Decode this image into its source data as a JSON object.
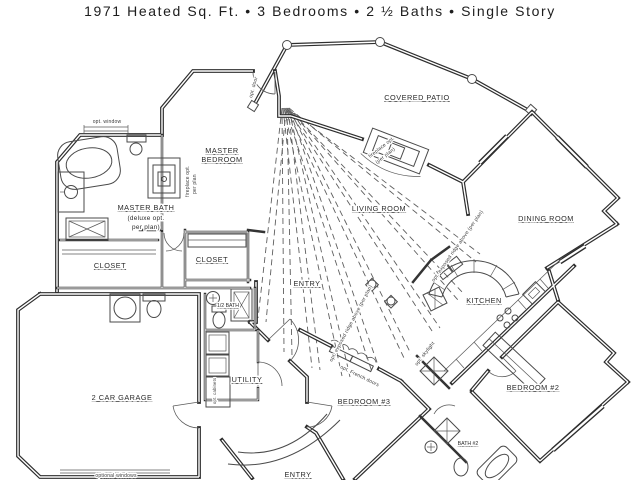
{
  "title": "1971 Heated Sq. Ft. • 3 Bedrooms • 2 ½ Baths • Single Story",
  "rooms": {
    "covered_patio": "COVERED PATIO",
    "master_line1": "MASTER",
    "master_line2": "BEDROOM",
    "master_bath": "MASTER BATH",
    "master_bath_note1": "(deluxe opt.",
    "master_bath_note2": "per plan)",
    "living_room": "LIVING ROOM",
    "dining_room": "DINING ROOM",
    "kitchen": "KITCHEN",
    "closet_left": "CLOSET",
    "closet_right": "CLOSET",
    "entry_upper": "ENTRY",
    "half_bath": "1/2 BATH",
    "utility": "UTILITY",
    "garage": "2 CAR GARAGE",
    "bedroom3": "BEDROOM #3",
    "bedroom2": "BEDROOM #2",
    "bath2": "BATH #2",
    "entry_lower": "ENTRY"
  },
  "annotations": {
    "opt_window": "opt. window",
    "opt_door": "opt. door",
    "fp_master_1": "fireplace opt.",
    "fp_master_2": "per plan",
    "fp_living_1": "fireplace opt.",
    "fp_living_2": "(per plan)",
    "ridge_note": "opt. exposed ridge above (per plan)",
    "french_doors": "opt. French doors",
    "skylight": "opt. skylight",
    "cabinets": "opt. cabinets",
    "optional_windows": "optional windows"
  },
  "colors": {
    "ink": "#2e2e2e",
    "paper": "#ffffff"
  }
}
